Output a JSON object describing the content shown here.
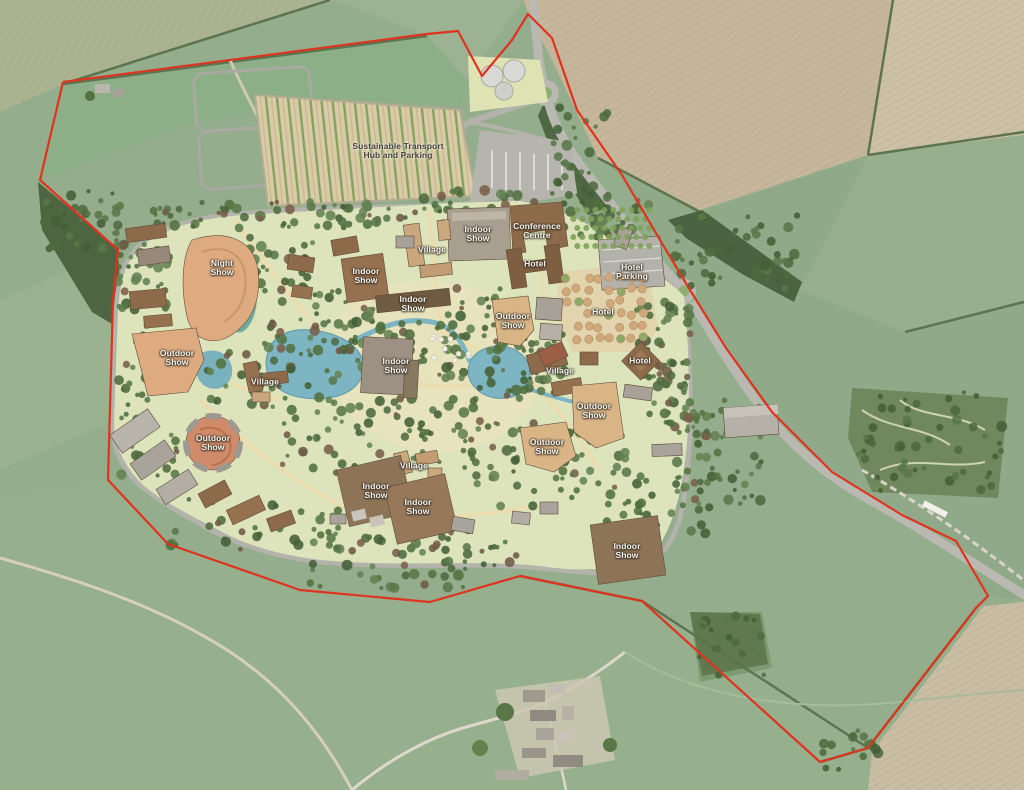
{
  "map": {
    "kind": "aerial-masterplan",
    "boundary_note": "red line application boundary"
  },
  "colors": {
    "boundary": "#e0331f",
    "lake": "#7db6c2",
    "park_base": "#dde4bb",
    "field_green": "#94ad8c",
    "field_tan": "#c6b79c",
    "road": "#b9b9b1",
    "building_brown": "#8d6a4a",
    "building_tan": "#d9b586",
    "building_gray": "#a8a198",
    "arena": "#d08c6a"
  },
  "labels": [
    {
      "id": "transport-hub",
      "text": "Sustainable Transport Hub and Parking"
    },
    {
      "id": "night-show",
      "text": "Night Show"
    },
    {
      "id": "indoor-show-1",
      "text": "Indoor Show"
    },
    {
      "id": "village-1",
      "text": "Village"
    },
    {
      "id": "indoor-show-2",
      "text": "Indoor Show"
    },
    {
      "id": "conference-centre",
      "text": "Conference Centre"
    },
    {
      "id": "hotel-1",
      "text": "Hotel"
    },
    {
      "id": "hotel-parking",
      "text": "Hotel Parking"
    },
    {
      "id": "indoor-show-3",
      "text": "Indoor Show"
    },
    {
      "id": "outdoor-show-1",
      "text": "Outdoor Show"
    },
    {
      "id": "hotel-2",
      "text": "Hotel"
    },
    {
      "id": "outdoor-show-2",
      "text": "Outdoor Show"
    },
    {
      "id": "indoor-show-4",
      "text": "Indoor Show"
    },
    {
      "id": "village-2",
      "text": "Village"
    },
    {
      "id": "village-3",
      "text": "Village"
    },
    {
      "id": "hotel-3",
      "text": "Hotel"
    },
    {
      "id": "outdoor-show-3",
      "text": "Outdoor Show"
    },
    {
      "id": "outdoor-show-4",
      "text": "Outdoor Show"
    },
    {
      "id": "outdoor-show-5",
      "text": "Outdoor Show"
    },
    {
      "id": "village-4",
      "text": "Village"
    },
    {
      "id": "indoor-show-5",
      "text": "Indoor Show"
    },
    {
      "id": "indoor-show-6",
      "text": "Indoor Show"
    },
    {
      "id": "indoor-show-7",
      "text": "Indoor Show"
    }
  ]
}
